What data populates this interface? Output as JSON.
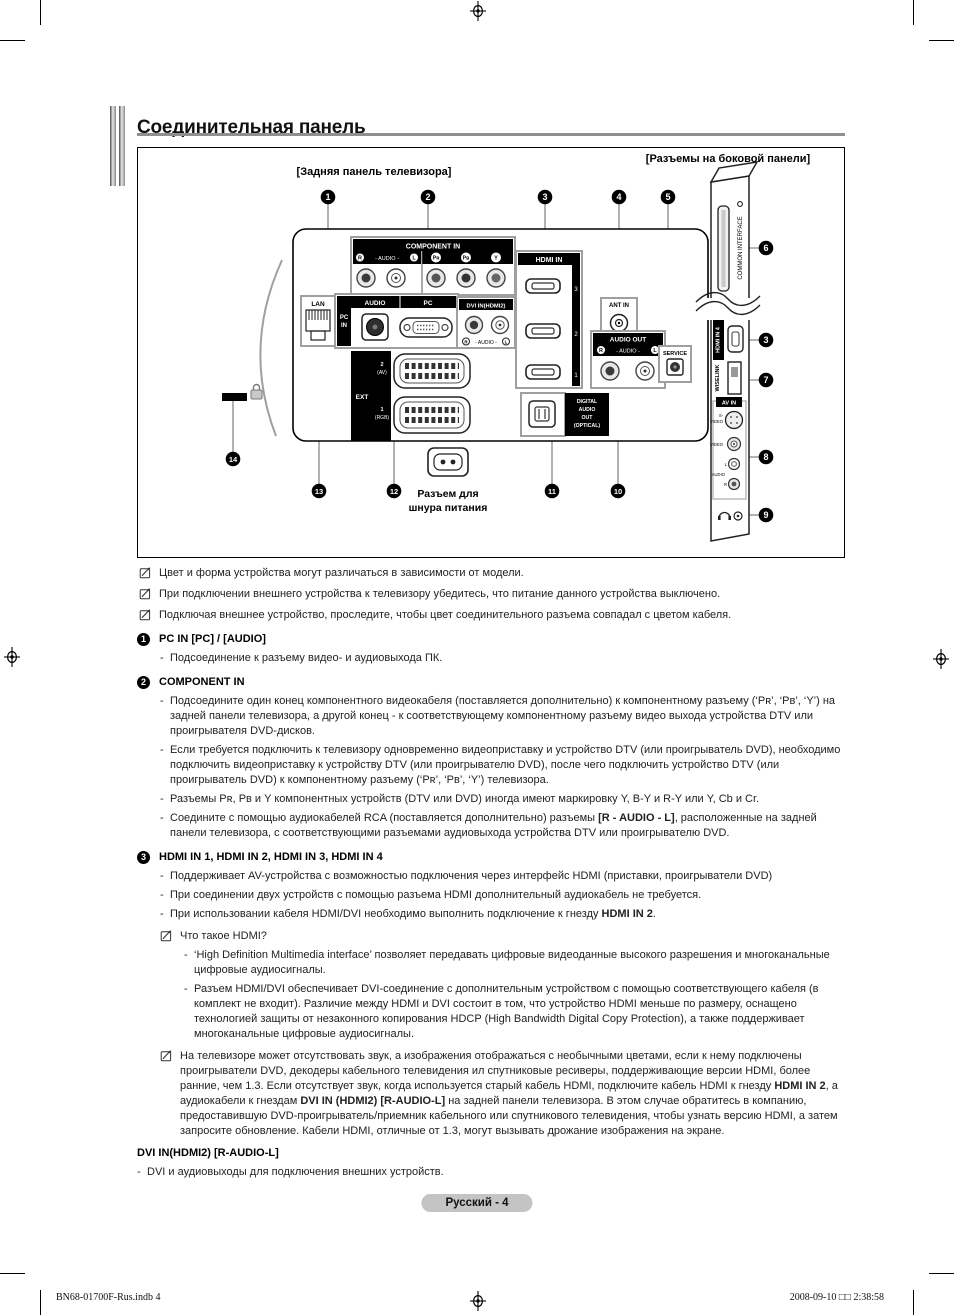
{
  "page": {
    "title": "Соединительная панель",
    "footer_pill": "Русский - 4",
    "print_footer_left": "BN68-01700F-Rus.indb   4",
    "print_footer_right": "2008-09-10   □□ 2:38:58"
  },
  "diagram": {
    "rear_panel_caption": "[Задняя панель телевизора]",
    "side_panel_caption": "[Разъемы на боковой панели]",
    "power_label_line1": "Разъем для",
    "power_label_line2": "шнура питания",
    "callouts": {
      "n1": "1",
      "n2": "2",
      "n3": "3",
      "n4": "4",
      "n5": "5",
      "n6": "6",
      "n3s": "3",
      "n7": "7",
      "n8": "8",
      "n9": "9",
      "n10": "10",
      "n11": "11",
      "n12": "12",
      "n13": "13",
      "n14": "14"
    },
    "labels": {
      "component_in": "COMPONENT IN",
      "audio_r": "R",
      "audio_l": "L",
      "audio_mid": "- AUDIO -",
      "pr": "Pʀ",
      "pb": "Pʙ",
      "y": "Y",
      "hdmi_in": "HDMI IN",
      "hdmi_3": "3",
      "hdmi_2": "2",
      "hdmi_1": "1",
      "lan": "LAN",
      "pc_in_l1": "PC",
      "pc_in_l2": "IN",
      "audio": "AUDIO",
      "pc": "PC",
      "dvi_in": "DVI IN(HDMI2)",
      "dvi_audio_mid": "- AUDIO -",
      "ext": "EXT",
      "ext2_num": "2",
      "ext2_type": "(AV)",
      "ext1_num": "1",
      "ext1_type": "(RGB)",
      "ant_in": "ANT IN",
      "audio_out": "AUDIO OUT",
      "service": "SERVICE",
      "digital1": "DIGITAL",
      "digital2": "AUDIO",
      "digital3": "OUT",
      "digital4": "(OPTICAL)",
      "common_interface": "COMMON INTERFACE",
      "hdmi_in4": "HDMI IN 4",
      "wiselink": "WISELINK",
      "av_in": "AV IN",
      "s_video_l1": "S-",
      "s_video_l2": "VIDEO",
      "video": "VIDEO",
      "audio_side": "AUDIO",
      "jack_l": "L",
      "jack_r": "R"
    }
  },
  "notes": [
    "Цвет и форма устройства могут различаться в зависимости от модели.",
    "При подключении внешнего устройства к телевизору убедитесь, что питание данного устройства выключено.",
    "Подключая внешнее устройство, проследите, чтобы цвет соединительного разъема совпадал с цветом кабеля."
  ],
  "sections": {
    "s1": {
      "num": "1",
      "title": "PC IN [PC] / [AUDIO]",
      "b1": "Подсоединение к разъему видео- и аудиовыхода ПК."
    },
    "s2": {
      "num": "2",
      "title": "COMPONENT IN",
      "b1": "Подсоедините один конец компонентного видеокабеля (поставляется дополнительно) к компонентному разъему (‘Pʀ’, ‘Pʙ’, ‘Y’) на задней панели телевизора, а другой конец - к соответствующему компонентному разъему видео выхода устройства DTV или проигрывателя DVD-дисков.",
      "b2": "Если требуется подключить к телевизору одновременно видеоприставку и устройство DTV (или проигрыватель DVD), необходимо подключить видеоприставку к устройству DTV (или проигрывателю DVD), после чего подключить устройство DTV (или проигрыватель DVD) к компонентному разъему (‘Pʀ’, ‘Pʙ’, ‘Y’) телевизора.",
      "b3": "Разъемы Pʀ, Pʙ и Y компонентных устройств (DTV или DVD) иногда имеют маркировку Y, B-Y и R-Y или Y, Cb и Cr.",
      "b4": [
        {
          "t": "Соедините с помощью аудиокабелей RCA (поставляется дополнительно) разъемы "
        },
        {
          "t": "[R - AUDIO - L]",
          "b": true
        },
        {
          "t": ", расположенные на задней панели телевизора, с соответствующими разъемами аудиовыхода устройства DTV или проигрывателю DVD."
        }
      ]
    },
    "s3": {
      "num": "3",
      "title": "HDMI IN 1, HDMI IN 2, HDMI IN 3, HDMI IN 4",
      "b1": "Поддерживает AV-устройства с возможностью подключения через интерфейс HDMI (приставки, проигрыватели DVD)",
      "b2": "При соединении двух устройств с помощью разъема HDMI дополнительный аудиокабель не требуется.",
      "b3": [
        {
          "t": "При использовании кабеля HDMI/DVI необходимо выполнить подключение к гнезду "
        },
        {
          "t": "HDMI IN 2",
          "b": true
        },
        {
          "t": "."
        }
      ],
      "note1_title": "Что такое HDMI?",
      "note1_b1": "‘High Definition Multimedia interface’ позволяет передавать цифровые видеоданные высокого разрешения и многоканальные цифровые аудиосигналы.",
      "note1_b2": "Разъем HDMI/DVI обеспечивает DVI-соединение с дополнительным устройством с помощью соответствующего кабеля (в комплект не входит). Различие между HDMI и DVI состоит в том, что устройство HDMI меньше по размеру, оснащено технологией защиты от незаконного копирования HDCP (High Bandwidth Digital Copy Protection), а также поддерживает многоканальные цифровые аудиосигналы.",
      "note2": [
        {
          "t": "На телевизоре может отсутствовать звук, а изображения отображаться с необычными цветами, если к нему подключены проигрыватели DVD, декодеры кабельного телевидения ил спутниковые ресиверы, поддерживающие версии HDMI, более ранние, чем 1.3. Если отсутствует звук, когда используется старый кабель HDMI, подключите кабель HDMI к гнезду "
        },
        {
          "t": "HDMI IN 2",
          "b": true
        },
        {
          "t": ", а аудиокабели к гнездам "
        },
        {
          "t": "DVI IN (HDMI2) [R-AUDIO-L]",
          "b": true
        },
        {
          "t": " на задней панели телевизора. В этом случае обратитесь в компанию, предоставившую DVD-проигрыватель/приемник кабельного или спутникового телевидения, чтобы узнать версию HDMI, а затем запросите обновление. Кабели HDMI, отличные от 1.3, могут вызывать дрожание изображения на экране."
        }
      ]
    },
    "s4": {
      "title": "DVI IN(HDMI2) [R-AUDIO-L]",
      "b1": "DVI и аудиовыходы для подключения внешних устройств."
    }
  }
}
